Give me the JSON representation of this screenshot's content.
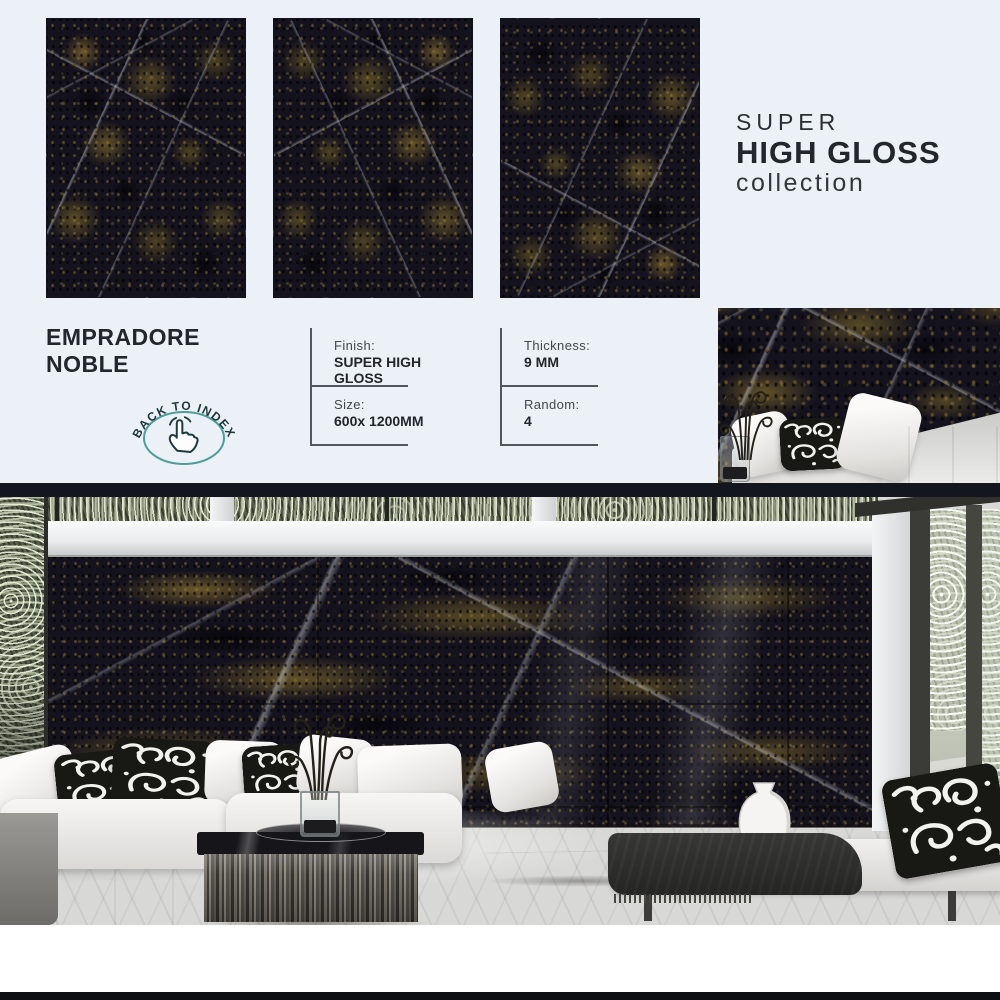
{
  "collection_header": {
    "line1": "SUPER",
    "line2": "HIGH GLOSS",
    "line3": "collection"
  },
  "product": {
    "name": "EMPRADORE NOBLE"
  },
  "back_button": {
    "label": "BACK TO INDEX",
    "icon": "tap-hand-icon"
  },
  "specs": {
    "finish": {
      "label": "Finish:",
      "value": "SUPER HIGH GLOSS"
    },
    "size": {
      "label": "Size:",
      "value": "600x 1200MM"
    },
    "thickness": {
      "label": "Thickness:",
      "value": "9 MM"
    },
    "random": {
      "label": "Random:",
      "value": "4"
    }
  },
  "colors": {
    "background_blue": "#ecf1f8",
    "text_dark": "#23262b",
    "accent_teal": "#4d9e9a",
    "marble_base": "#14121d",
    "marble_brown": "#6b5a2d",
    "dark_bar": "#13161f"
  }
}
